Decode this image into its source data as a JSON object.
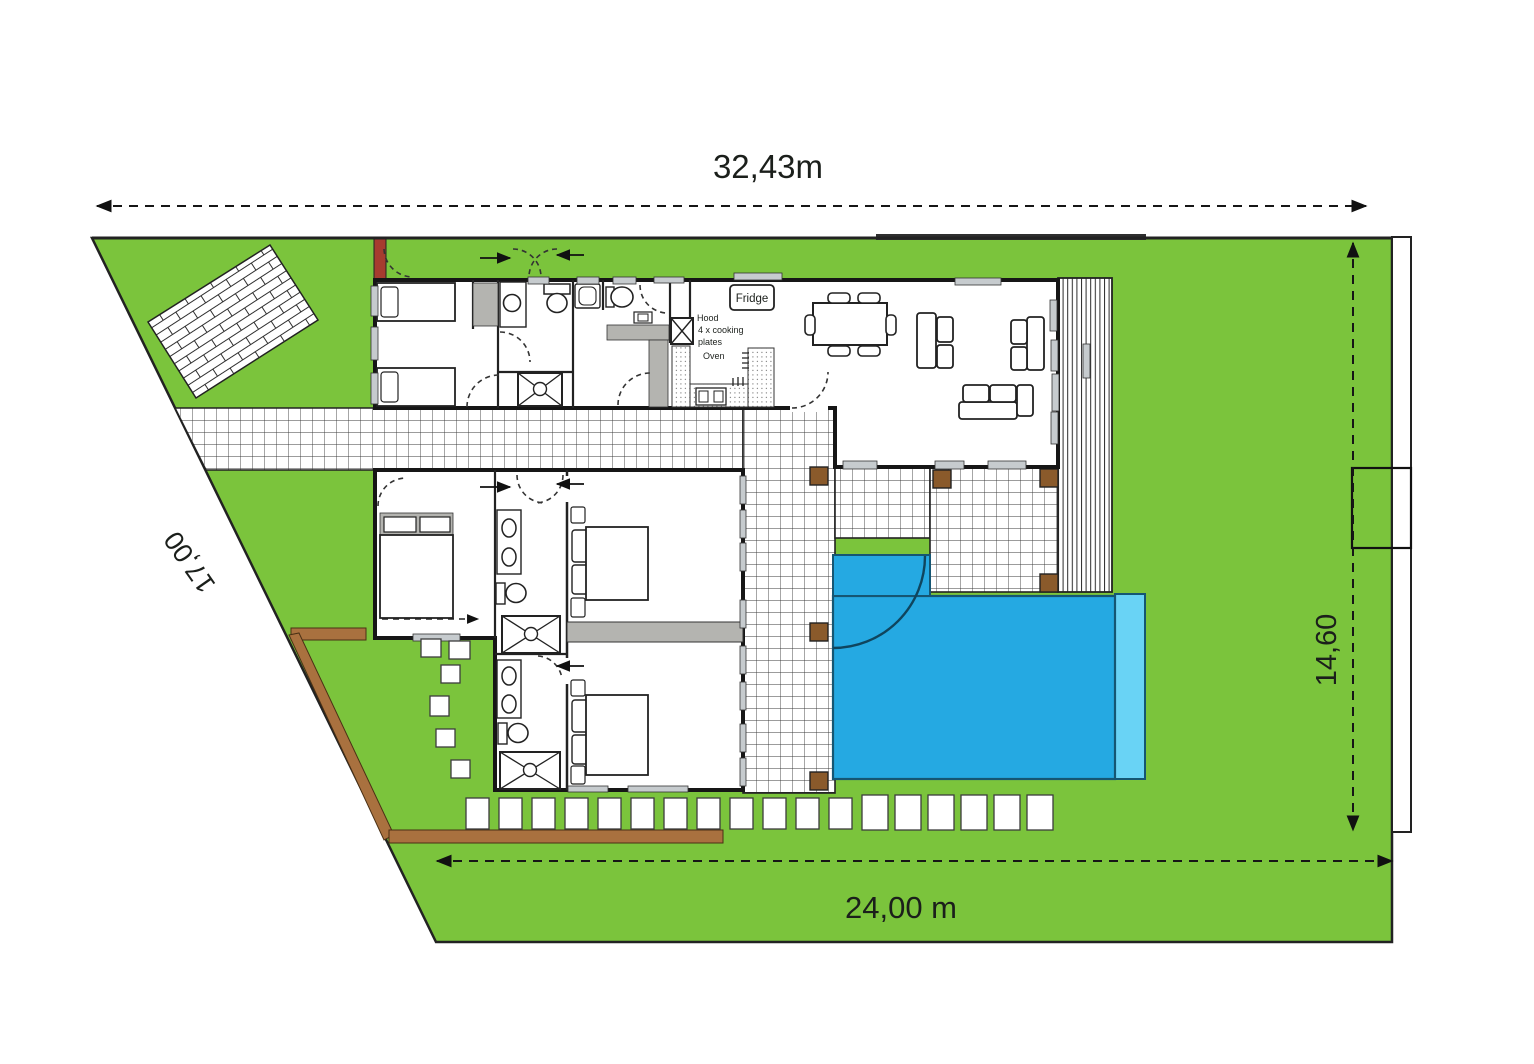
{
  "page": {
    "title": "Villa site plan"
  },
  "dimensions": {
    "top": "32,43m",
    "bottom": "24,00 m",
    "right": "14,60",
    "left": "17,00"
  },
  "kitchen": {
    "fridge": "Fridge",
    "hood": "Hood",
    "cooking_line1": "4 x cooking",
    "cooking_line2": "plates",
    "oven": "Oven"
  },
  "colors": {
    "grass": "#7bc43c",
    "pool": "#25a9e2",
    "pool_light": "#69d3f5",
    "wood": "#a9713f",
    "post": "#8a5a2b",
    "gate": "#a63c2f",
    "wall_gray": "#b4b4b0",
    "window_gray": "#c6cbce"
  }
}
